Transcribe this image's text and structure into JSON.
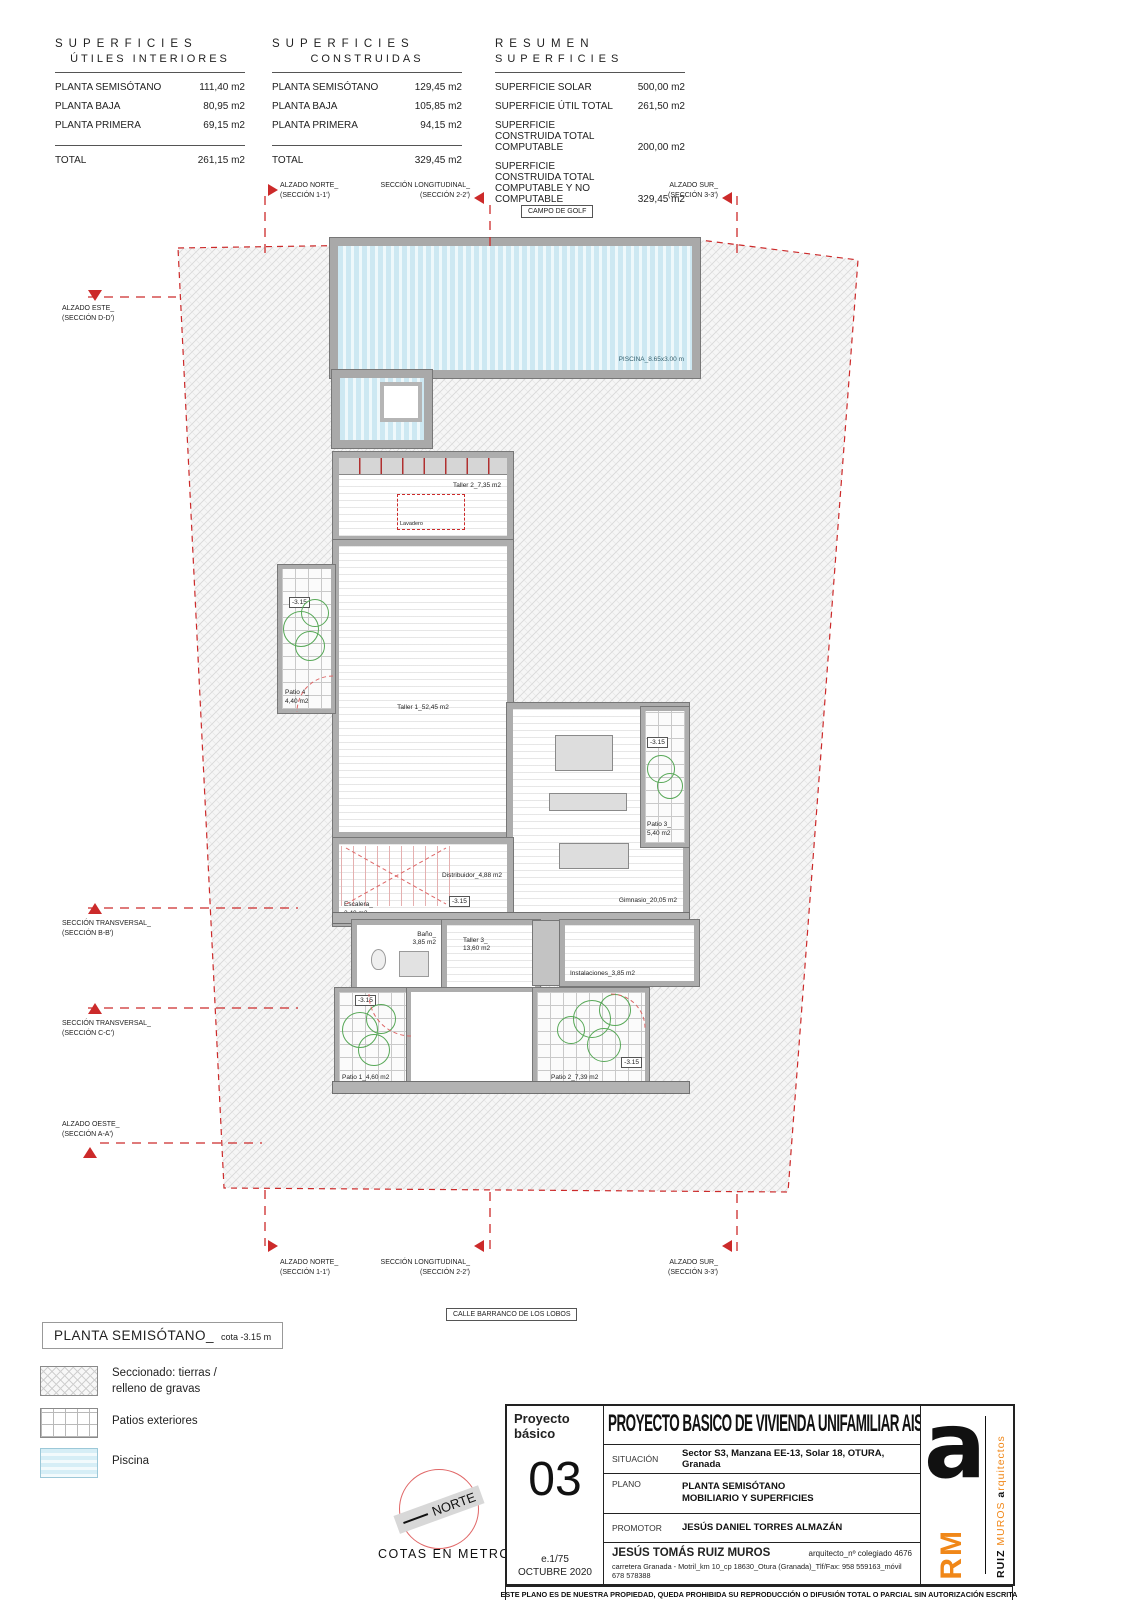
{
  "sheet": {
    "context_top": "CAMPO DE GOLF",
    "context_bottom": "CALLE BARRANCO DE LOS LOBOS",
    "cotas": "COTAS EN METROS",
    "north": "NORTE"
  },
  "tables": {
    "utiles": {
      "title_line1": "SUPERFICIES",
      "title_line2": "ÚTILES INTERIORES",
      "rows": [
        [
          "PLANTA SEMISÓTANO",
          "111,40 m2"
        ],
        [
          "PLANTA BAJA",
          "80,95 m2"
        ],
        [
          "PLANTA PRIMERA",
          "69,15 m2"
        ]
      ],
      "total_label": "TOTAL",
      "total_value": "261,15 m2"
    },
    "construidas": {
      "title_line1": "SUPERFICIES",
      "title_line2": "CONSTRUIDAS",
      "rows": [
        [
          "PLANTA SEMISÓTANO",
          "129,45 m2"
        ],
        [
          "PLANTA BAJA",
          "105,85 m2"
        ],
        [
          "PLANTA PRIMERA",
          "94,15 m2"
        ]
      ],
      "total_label": "TOTAL",
      "total_value": "329,45 m2"
    },
    "resumen": {
      "title_line1": "RESUMEN",
      "title_line2": "SUPERFICIES",
      "rows": [
        [
          "SUPERFICIE SOLAR",
          "500,00 m2"
        ],
        [
          "SUPERFICIE ÚTIL TOTAL",
          "261,50 m2"
        ],
        [
          "SUPERFICIE CONSTRUIDA TOTAL COMPUTABLE",
          "200,00 m2"
        ],
        [
          "SUPERFICIE CONSTRUIDA TOTAL COMPUTABLE Y NO COMPUTABLE",
          "329,45 m2"
        ]
      ]
    }
  },
  "sections": {
    "alzado_norte": {
      "l1": "ALZADO NORTE_",
      "l2": "(SECCIÓN 1-1')"
    },
    "seccion_longitudinal": {
      "l1": "SECCIÓN LONGITUDINAL_",
      "l2": "(SECCIÓN 2-2')"
    },
    "alzado_sur": {
      "l1": "ALZADO SUR_",
      "l2": "(SECCIÓN 3-3')"
    },
    "alzado_este": {
      "l1": "ALZADO ESTE_",
      "l2": "(SECCIÓN D-D')"
    },
    "seccion_transversal_b": {
      "l1": "SECCIÓN TRANSVERSAL_",
      "l2": "(SECCIÓN B-B')"
    },
    "seccion_transversal_c": {
      "l1": "SECCIÓN TRANSVERSAL_",
      "l2": "(SECCIÓN C-C')"
    },
    "alzado_oeste": {
      "l1": "ALZADO OESTE_",
      "l2": "(SECCIÓN A-A')"
    }
  },
  "plan": {
    "piscina": "PISCINA_8.65x3.00 m",
    "taller2": "Taller 2_7,35 m2",
    "lavadero": "Lavadero",
    "taller1": "Taller 1_52,45 m2",
    "patio4_l1": "Patio 4_",
    "patio4_l2": "4,40 m2",
    "patio3_l1": "Patio 3_",
    "patio3_l2": "5,40 m2",
    "gimnasio": "Gimnasio_20,05 m2",
    "distribuidor": "Distribuidor_4,88 m2",
    "escalera_l1": "Escalera_",
    "escalera_l2": "3,40 m2",
    "bano_l1": "Baño_",
    "bano_l2": "3,85 m2",
    "taller3_l1": "Taller 3_",
    "taller3_l2": "13,60 m2",
    "instalaciones": "Instalaciones_3,85 m2",
    "patio1": "Patio 1_4,60 m2",
    "patio2": "Patio 2_7,39 m2",
    "level": "-3.15"
  },
  "legend": {
    "title": "PLANTA SEMISÓTANO_",
    "title_suffix": "cota -3.15 m",
    "item1_l1": "Seccionado: tierras /",
    "item1_l2": "relleno de gravas",
    "item2": "Patios exteriores",
    "item3": "Piscina"
  },
  "titleblock": {
    "corner_l1": "Proyecto",
    "corner_l2": "básico",
    "sheet_no": "03",
    "scale": "e.1/75",
    "date": "OCTUBRE 2020",
    "main_title": "PROYECTO BASICO DE VIVIENDA UNIFAMILIAR AISLADA",
    "situacion_label": "SITUACIÓN",
    "situacion_value": "Sector S3, Manzana EE-13, Solar 18, OTURA, Granada",
    "plano_label": "PLANO",
    "plano_value_l1": "PLANTA SEMISÓTANO",
    "plano_value_l2": "MOBILIARIO Y SUPERFICIES",
    "promotor_label": "PROMOTOR",
    "promotor_value": "JESÚS DANIEL TORRES ALMAZÁN",
    "architect_name": "JESÚS TOMÁS RUIZ MUROS",
    "architect_reg": "arquitecto_nº colegiado 4676",
    "architect_address": "carretera Granada - Motril_km 10_cp 18630_Otura (Granada)_Tlf/Fax: 958 559163_móvil 678 578388",
    "footer": "ESTE PLANO ES DE NUESTRA PROPIEDAD, QUEDA PROHIBIDA SU REPRODUCCIÓN O DIFUSIÓN TOTAL O PARCIAL SIN AUTORIZACIÓN ESCRITA",
    "logo": {
      "big_a": "a",
      "rm": "RM",
      "ruiz": "RUIZ",
      "muros": "MUROS",
      "arq_first": "a",
      "arq_rest": "rquitectos"
    }
  },
  "colors": {
    "accent_red": "#cc2a2a",
    "pool_blue": "#cde8f2",
    "tree_green": "#57a857",
    "wall_gray": "#adadad",
    "logo_orange": "#f08718"
  }
}
